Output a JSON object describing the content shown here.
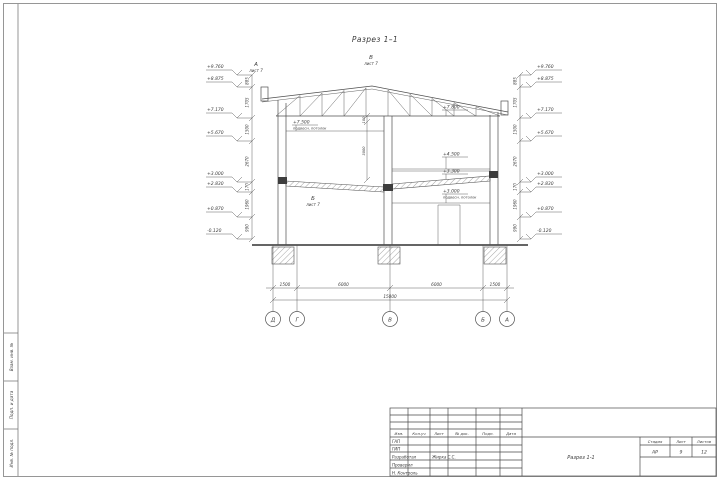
{
  "section": {
    "title": "Разрез 1–1",
    "elevations": [
      "+9.760",
      "+8.875",
      "+7.170",
      "+5.670",
      "+3.000",
      "+2.830",
      "+0.870",
      "-0.120"
    ],
    "dim_chain": [
      "885",
      "1705",
      "1500",
      "2670",
      "170",
      "1960",
      "990"
    ],
    "labels": {
      "ceiling_upper": {
        "value": "+7.500",
        "note": "подвесн. потолок"
      },
      "truss_bottom": {
        "value": "+7.800"
      },
      "mezzanine": {
        "value": "+4.500"
      },
      "slab_top": {
        "value": "+3.300"
      },
      "ceiling_lower": {
        "value": "+3.000",
        "note": "подвесн. потолок"
      }
    },
    "center_dims": [
      "100",
      "3000"
    ],
    "callouts": [
      {
        "letter": "А",
        "ref": "лист 7"
      },
      {
        "letter": "В",
        "ref": "лист 7"
      },
      {
        "letter": "Б",
        "ref": "лист 7"
      }
    ],
    "bottom_dims": {
      "segments": [
        "1500",
        "6000",
        "6000",
        "1500"
      ],
      "total": "15000"
    },
    "axes": [
      "Д",
      "Г",
      "В",
      "Б",
      "А"
    ]
  },
  "title_block": {
    "header": [
      "Изм.",
      "Кол.уч",
      "Лист",
      "№ док.",
      "Подп.",
      "Дата"
    ],
    "rows": [
      {
        "label": "ГАП",
        "name": ""
      },
      {
        "label": "ГИП",
        "name": ""
      },
      {
        "label": "Разработал",
        "name": "Жирка С.С."
      },
      {
        "label": "Проверил",
        "name": ""
      },
      {
        "label": "Н. Контроль",
        "name": ""
      }
    ],
    "stage_header": [
      "Стадия",
      "Лист",
      "Листов"
    ],
    "stage_values": [
      "АР",
      "9",
      "12"
    ],
    "drawing_name": "Разрез 1-1"
  },
  "margin": {
    "labels": [
      "Взам. инв. №",
      "Подп. и дата",
      "Инв. № подл."
    ]
  }
}
